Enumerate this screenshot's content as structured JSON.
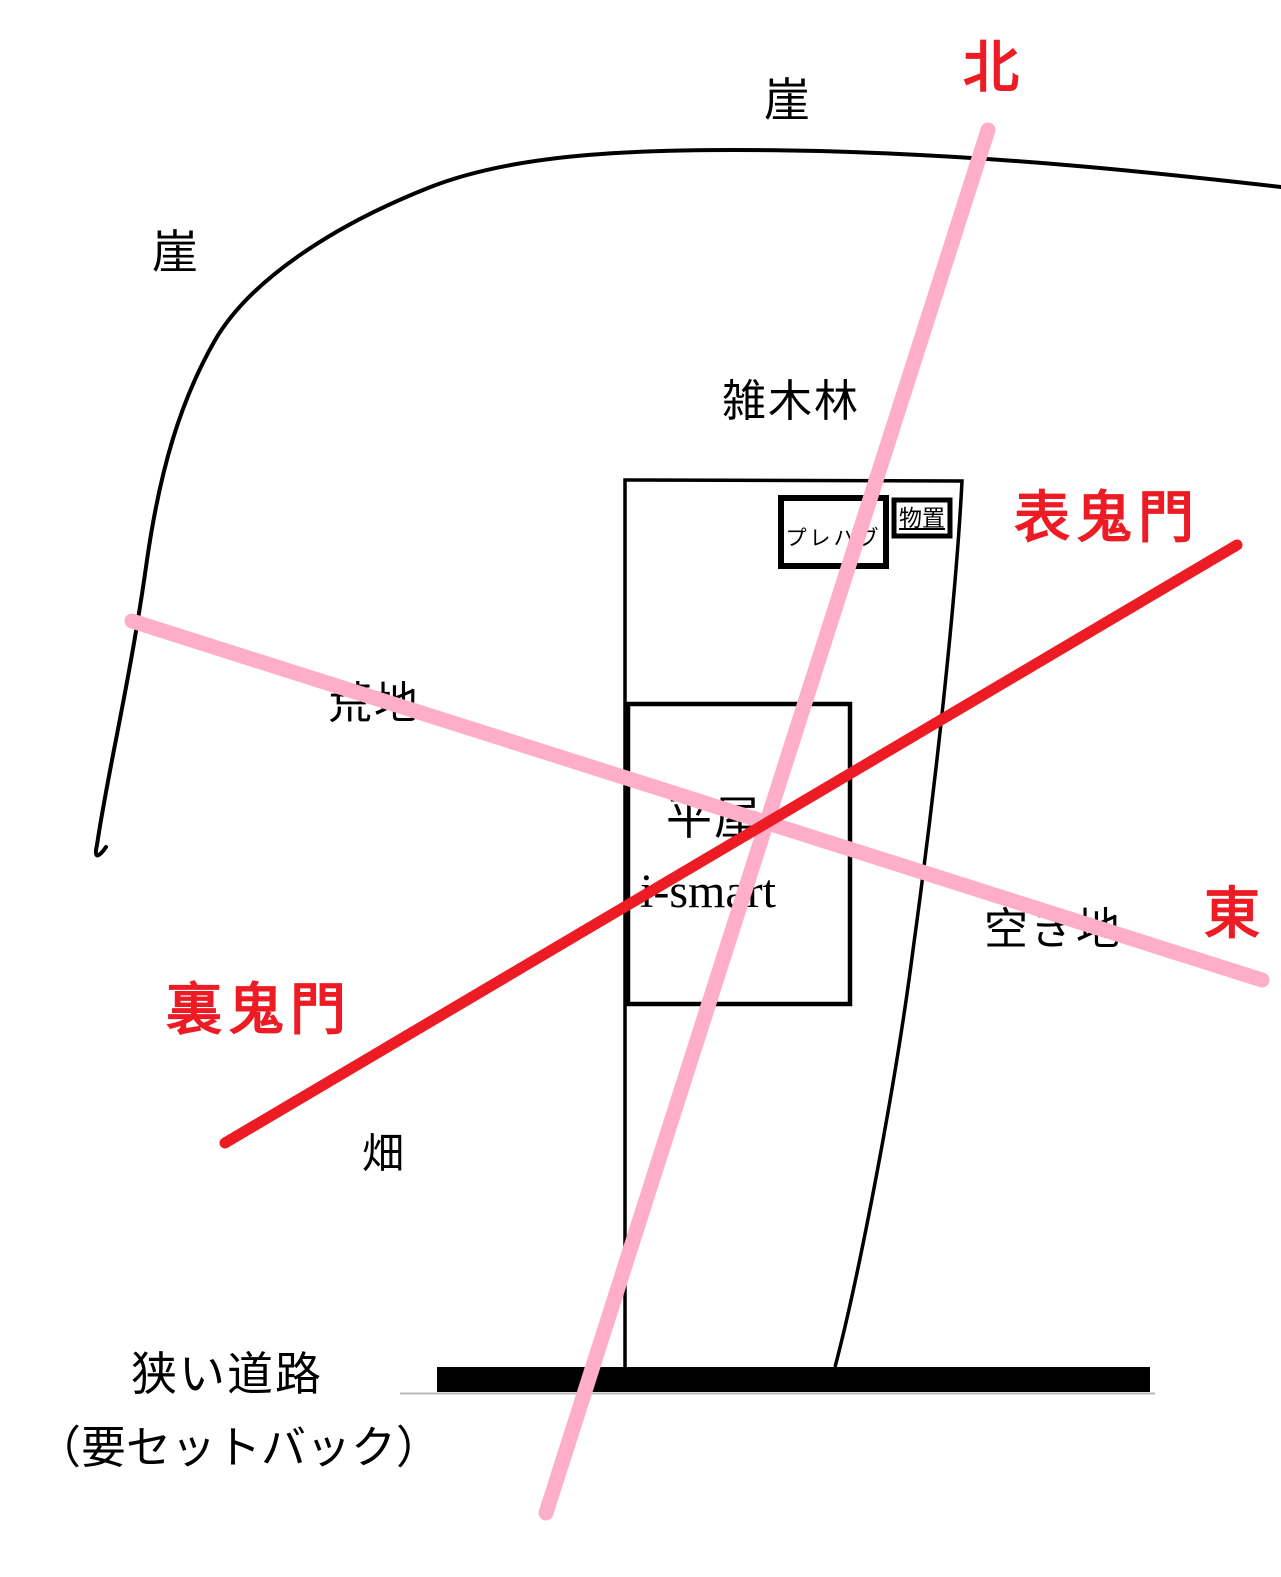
{
  "diagram": {
    "description_labels": {
      "cliff_top": "崖",
      "cliff_left": "崖",
      "woods": "雑木林",
      "wasteland": "荒地",
      "house_type": "平屋",
      "house_model": "i-smart",
      "prefab": "プレハブ",
      "shed": "物置",
      "vacant_lot": "空き地",
      "field": "畑",
      "road": "狭い道路",
      "road_note": "（要セットバック）"
    },
    "direction_labels": {
      "north": "北",
      "east": "東",
      "omote_kimon": "表鬼門",
      "ura_kimon": "裏鬼門"
    },
    "colors": {
      "black": "#000000",
      "red": "#ed1c24",
      "pink": "#ffaec9",
      "road_edge_gray": "#b8b8b8",
      "white": "#ffffff"
    },
    "lines": {
      "north_south_axis": "pink",
      "east_west_axis": "pink",
      "kimon_diagonal": "red"
    }
  }
}
